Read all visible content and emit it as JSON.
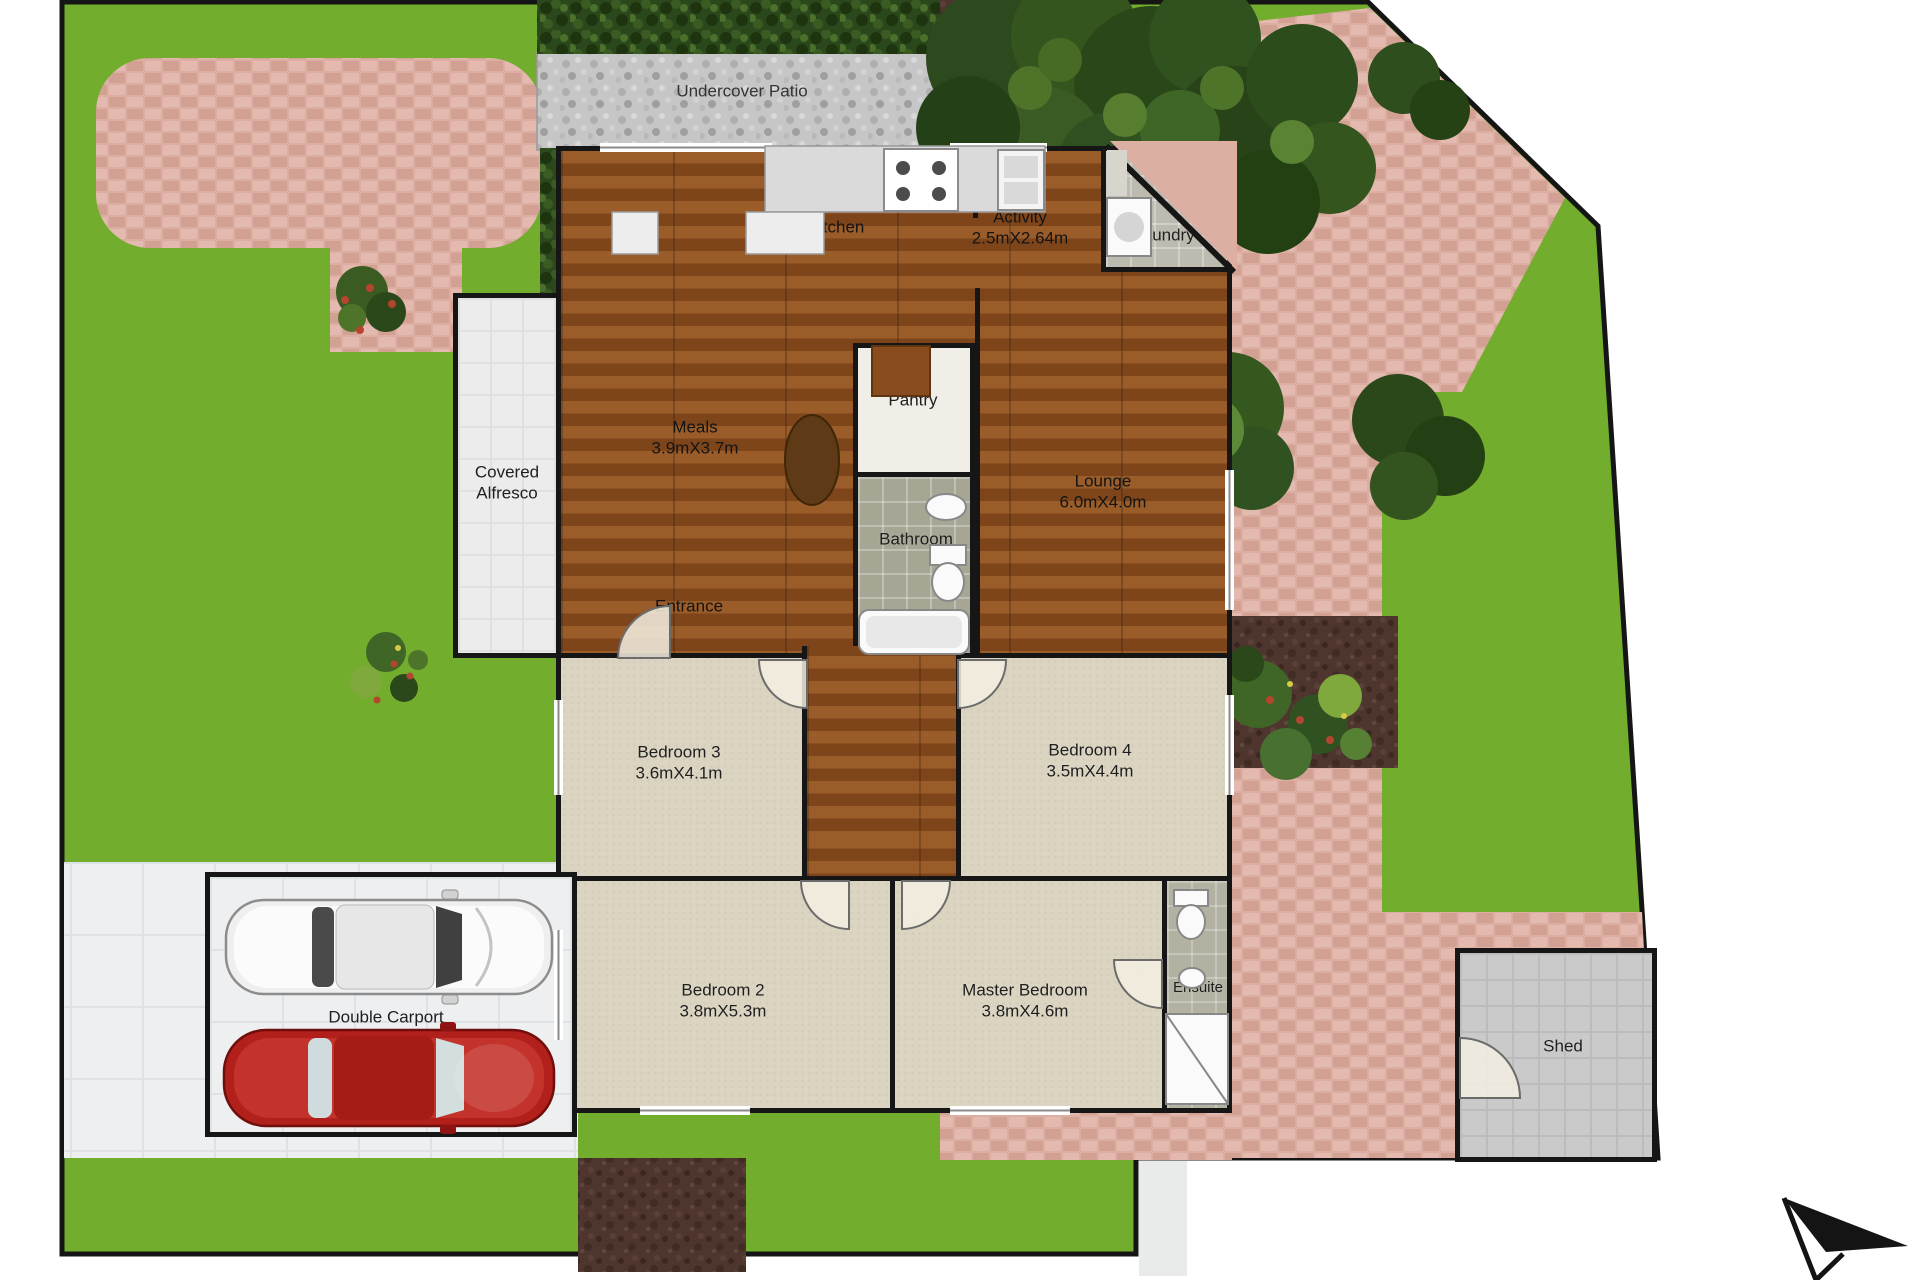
{
  "plan_title": "Residential site / floor plan",
  "colors": {
    "lawn": "#72ad2e",
    "paving": "#ddafa3",
    "gravel_patio": "#c4c4c4",
    "wood_floor": "#8a4e1e",
    "carpet": "#dbd4c1",
    "bath_tile": "#a7a695",
    "wall": "#161616",
    "soil": "#4e362e",
    "car_white": "#efefef",
    "car_red": "#b2201c"
  },
  "rooms": {
    "undercover_patio": {
      "name": "Undercover Patio"
    },
    "kitchen": {
      "name": "Kitchen"
    },
    "activity": {
      "name": "Activity",
      "dims": "2.5mX2.64m"
    },
    "laundry": {
      "name": "Laundry"
    },
    "meals": {
      "name": "Meals",
      "dims": "3.9mX3.7m"
    },
    "pantry": {
      "name": "Pantry"
    },
    "bathroom": {
      "name": "Bathroom"
    },
    "lounge": {
      "name": "Lounge",
      "dims": "6.0mX4.0m"
    },
    "covered_alfresco": {
      "name": "Covered Alfresco"
    },
    "entrance": {
      "name": "Entrance"
    },
    "bedroom3": {
      "name": "Bedroom 3",
      "dims": "3.6mX4.1m"
    },
    "bedroom4": {
      "name": "Bedroom 4",
      "dims": "3.5mX4.4m"
    },
    "bedroom2": {
      "name": "Bedroom 2",
      "dims": "3.8mX5.3m"
    },
    "master_bedroom": {
      "name": "Master Bedroom",
      "dims": "3.8mX4.6m"
    },
    "ensuite": {
      "name": "Ensuite"
    },
    "double_carport": {
      "name": "Double Carport"
    },
    "shed": {
      "name": "Shed"
    }
  }
}
